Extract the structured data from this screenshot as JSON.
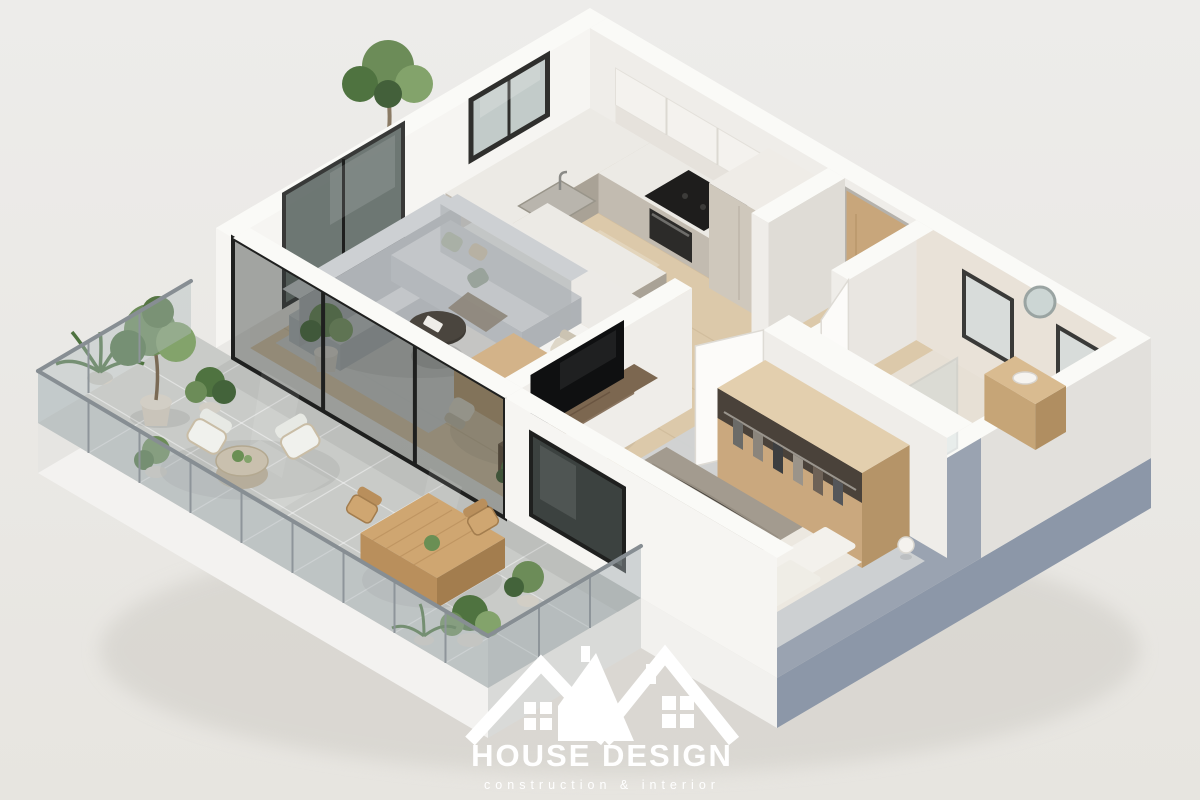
{
  "logo": {
    "title": "HOUSE DESIGN",
    "subtitle": "construction & interior"
  },
  "palette": {
    "bg": "#eae8e4",
    "wall_top": "#fafaf7",
    "wall_bright": "#f6f5f2",
    "wall_light": "#efede9",
    "wall_inner": "#e9e6e1",
    "wall_shade": "#dfdcd6",
    "exterior_blue": "#9aa3b1",
    "exterior_blue_dark": "#8c97a8",
    "slab_white": "#f3f2f0",
    "floor_wood": "#dcc9aa",
    "floor_bath": "#e7e0d5",
    "tile": "#c9cbc8",
    "rug": "#d0d3d4",
    "rug_bedroom": "#cdd0d2",
    "sofa": "#c3c6c9",
    "sofa_front": "#b4b8bc",
    "sofa_side": "#aeb2b6",
    "sofa_back": "#cdd0d3",
    "counter_top": "#eceae5",
    "counter_front": "#c2bbb0",
    "counter_side": "#a9a296",
    "cabinet_beige": "#cfc8bc",
    "cabinet_beige_dark": "#b5ad9f",
    "appliance_black": "#2c2b29",
    "door_wood": "#c8a67b",
    "table_wood": "#d3b389",
    "console_wood": "#7c6750",
    "wardrobe_wood": "#caa87e",
    "bed_blanket": "#a39b8f",
    "bed_sheet": "#e9e5dd",
    "pillow_white": "#f3f1ec",
    "glass_frame": "#1f201f",
    "railing_metal": "#8e959a",
    "plant_green": "#6c8c58",
    "plant_green_dark": "#4f7340",
    "plant_green_light": "#83a36b",
    "pot_gray": "#d2cec5",
    "white_obj": "#f4f2ee",
    "logo_white": "#ffffff"
  }
}
